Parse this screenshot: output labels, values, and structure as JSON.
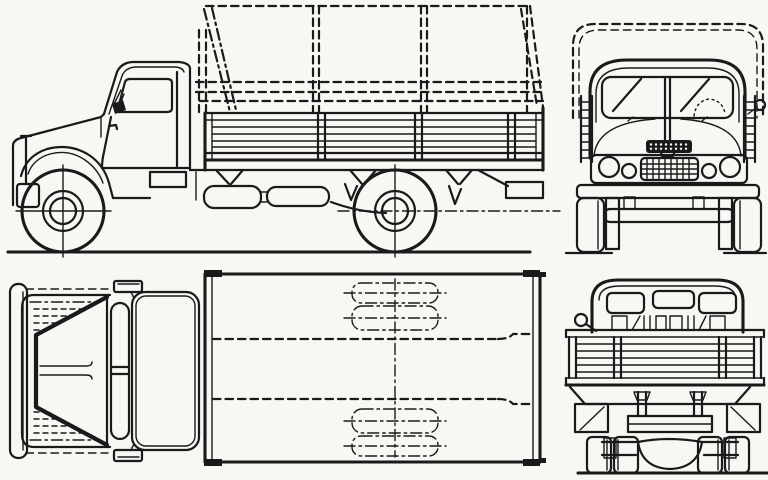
{
  "page": {
    "title": "Truck blueprint — four-view line drawing",
    "aria": "Black-and-white technical blueprint of a classic flatbed truck with dashed canvas tilt, shown in side, front, top-plan and rear views"
  },
  "colors": {
    "ink": "#1a1a1a",
    "paper": "#f7f7f4"
  },
  "views": {
    "side": {
      "label": "Side elevation view"
    },
    "front": {
      "label": "Front elevation view"
    },
    "plan": {
      "label": "Top plan view"
    },
    "rear": {
      "label": "Rear elevation view"
    }
  }
}
